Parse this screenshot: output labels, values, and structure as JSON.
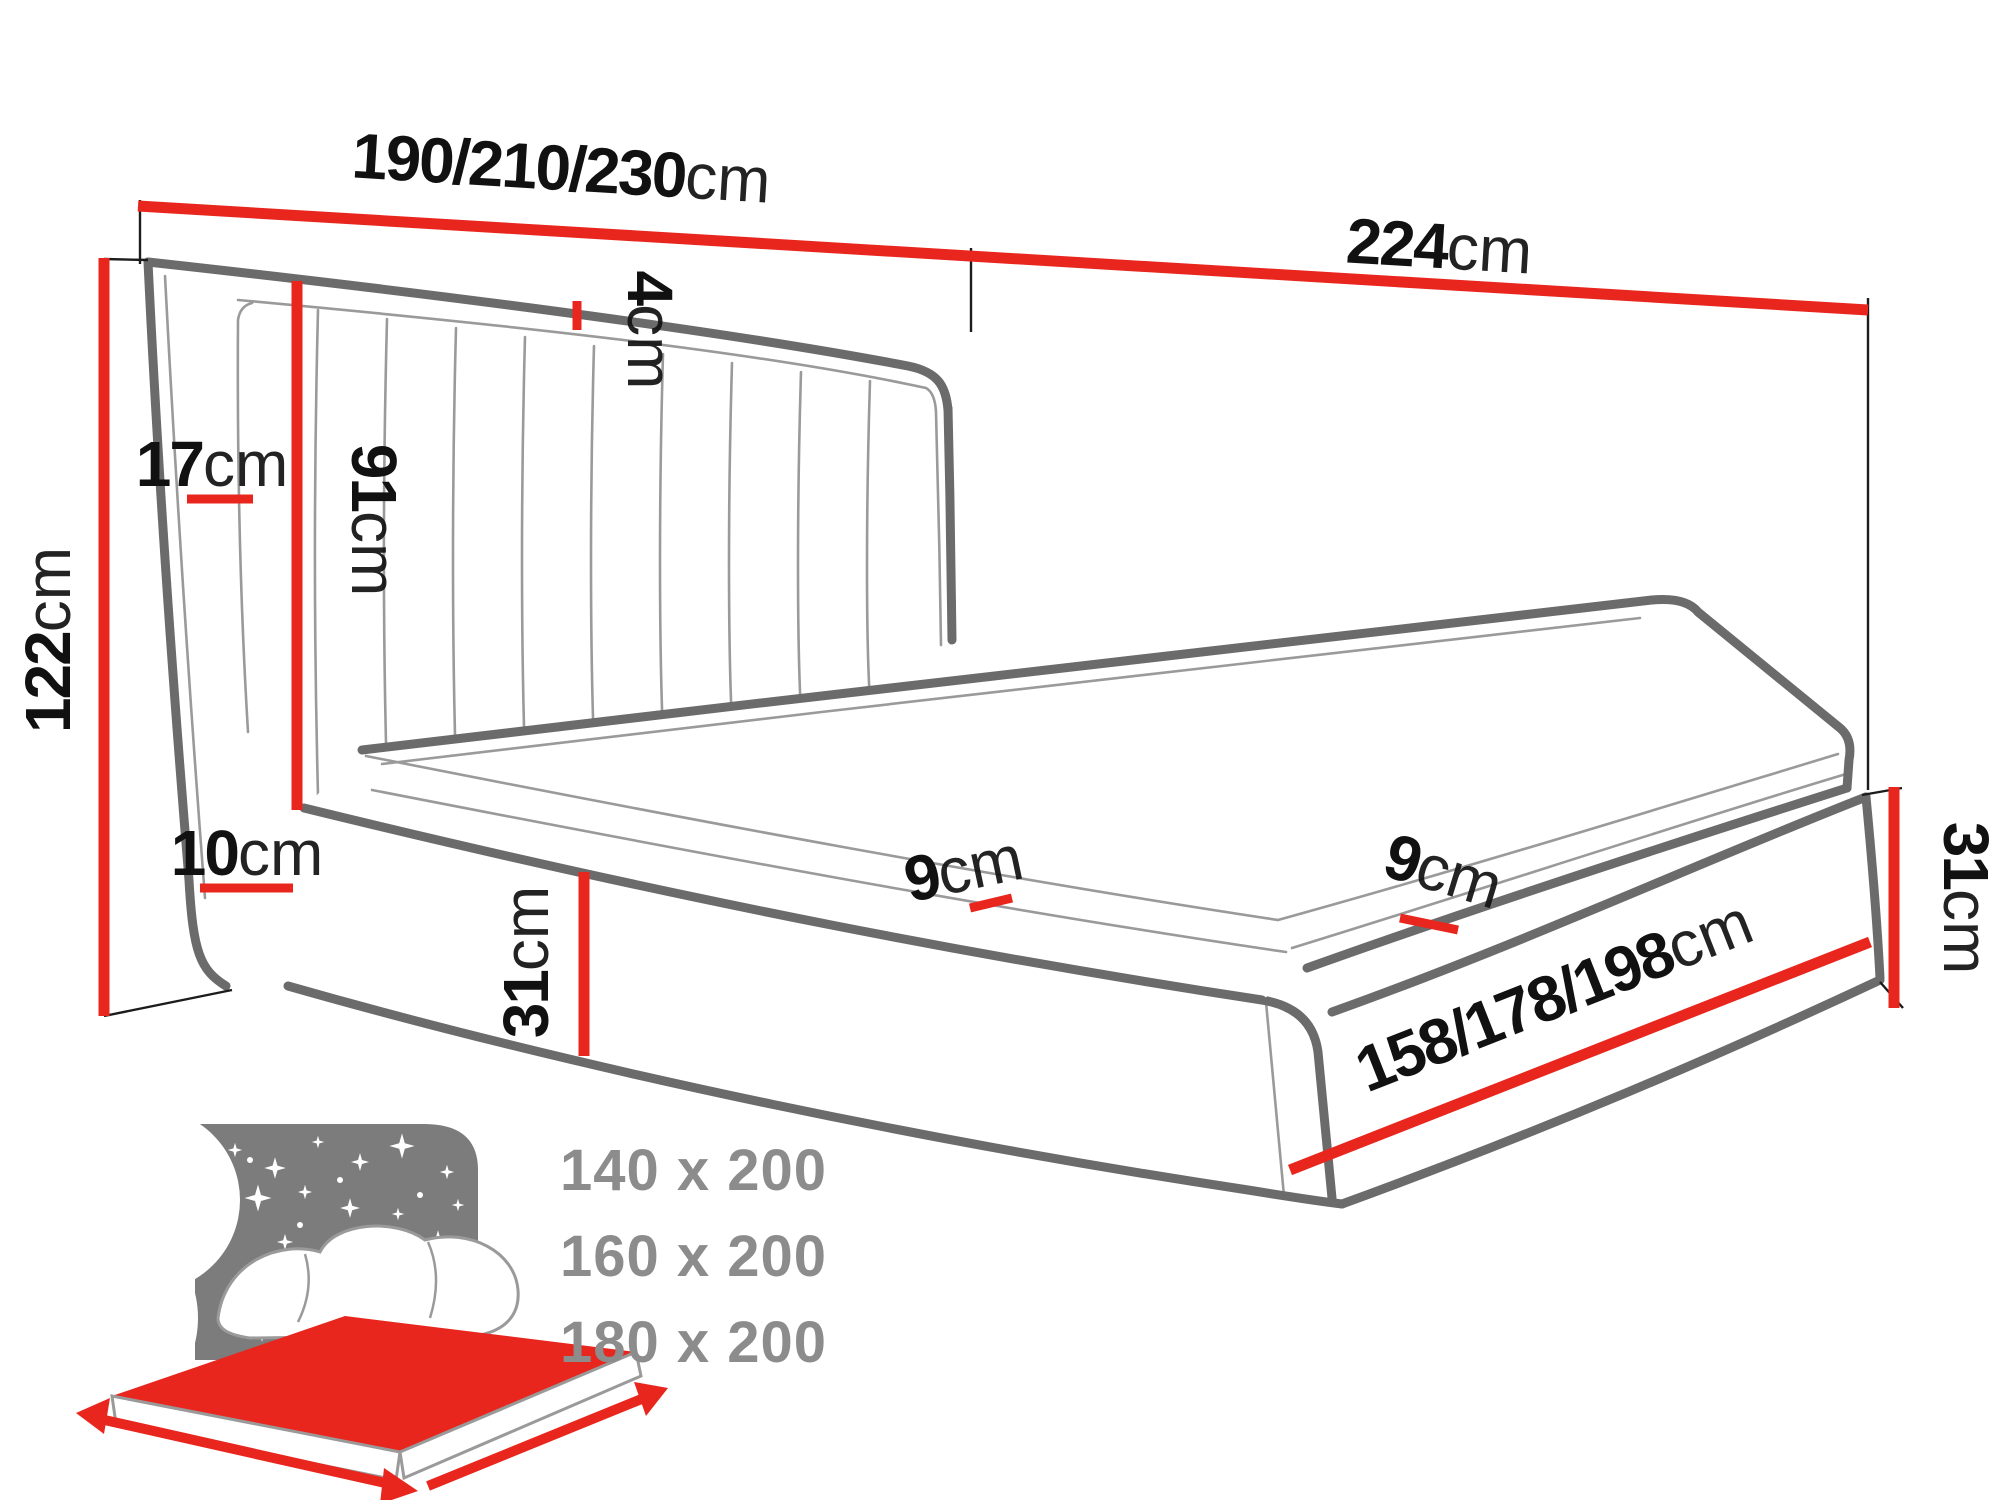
{
  "diagram": {
    "type": "furniture-dimension-diagram",
    "subject": "upholstered bed with channel-tufted headboard",
    "dimensions": {
      "headboard_width": {
        "num": "190/210/230",
        "unit": "cm"
      },
      "bed_length": {
        "num": "224",
        "unit": "cm"
      },
      "total_height": {
        "num": "122",
        "unit": "cm"
      },
      "headboard_thickness": {
        "num": "17",
        "unit": "cm"
      },
      "headboard_panel_height": {
        "num": "91",
        "unit": "cm"
      },
      "top_edge_gap": {
        "num": "4",
        "unit": "cm"
      },
      "base_inset": {
        "num": "10",
        "unit": "cm"
      },
      "base_height_front": {
        "num": "31",
        "unit": "cm"
      },
      "mattress_side_front": {
        "num": "9",
        "unit": "cm"
      },
      "mattress_side_right": {
        "num": "9",
        "unit": "cm"
      },
      "base_height_right": {
        "num": "31",
        "unit": "cm"
      },
      "bed_width": {
        "num": "158/178/198",
        "unit": "cm"
      }
    },
    "icon": {
      "name": "bed-sizes-icon",
      "sizes": [
        "140 x 200",
        "160 x 200",
        "180 x 200"
      ]
    },
    "colors": {
      "dimension_red": "#e8261e",
      "outline_gray": "#6b6b6b",
      "thin_gray": "#9a9a9a",
      "extension_black": "#1c1c1c",
      "icon_gray": "#7c7c7c",
      "sizes_gray": "#8c8c8c",
      "text_black": "#111111"
    }
  }
}
